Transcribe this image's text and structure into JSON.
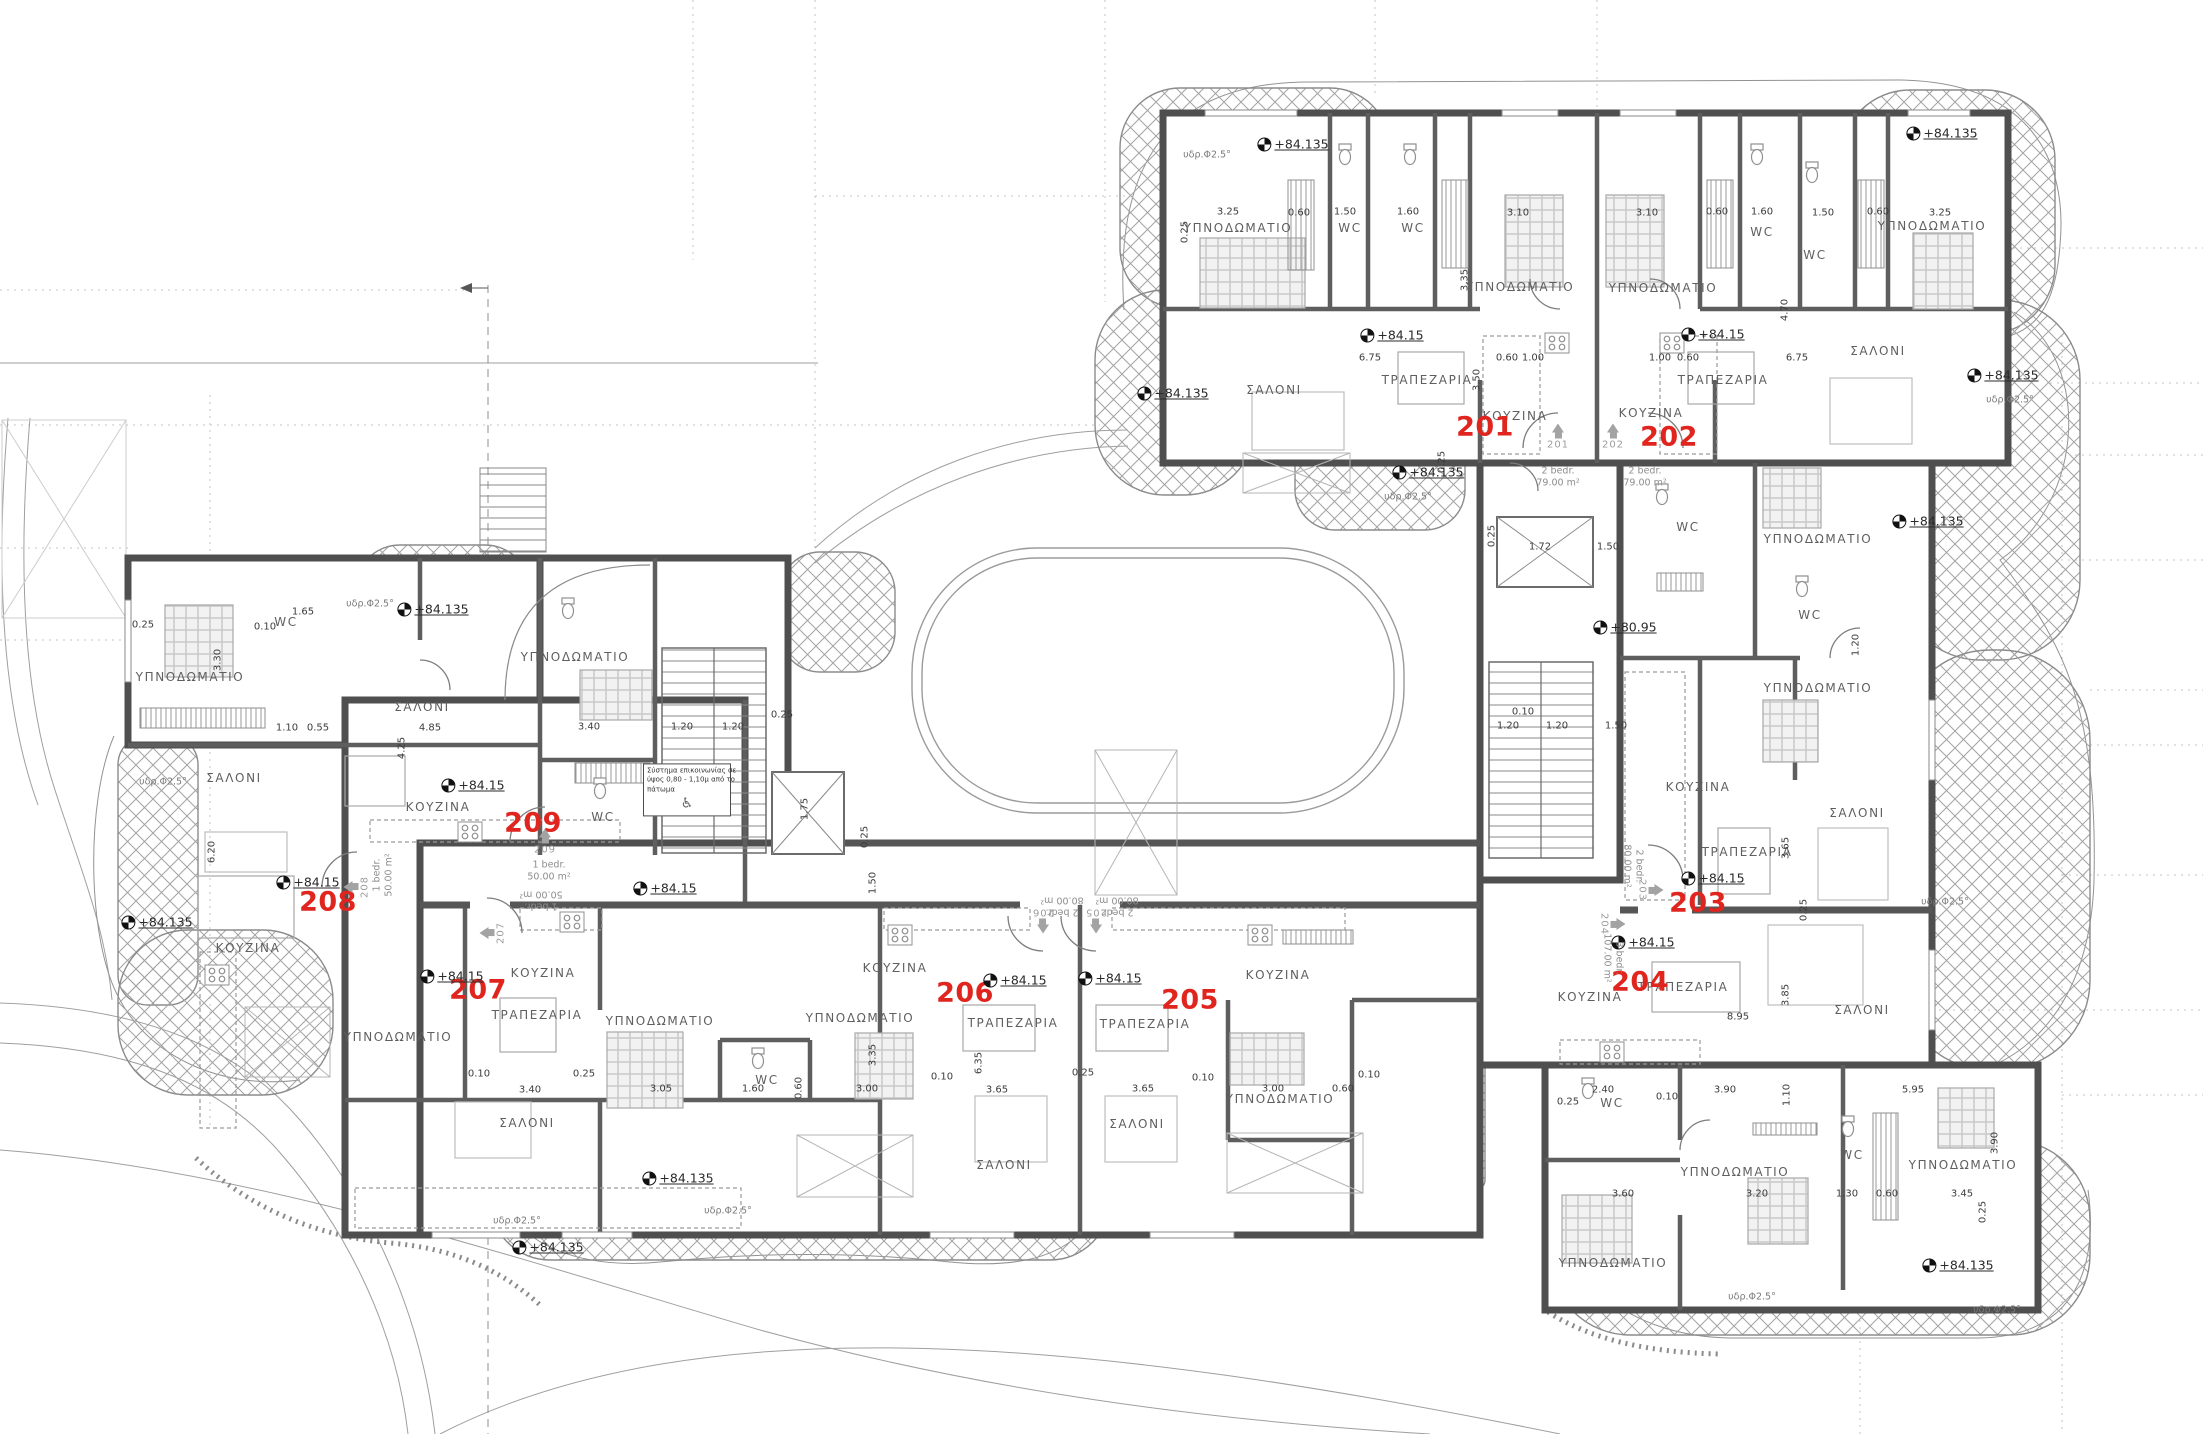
{
  "palette": {
    "red": "#e0251f",
    "wall": "#4f4f4f",
    "innerwall": "#616161",
    "hatch": "#9a9a9a",
    "text": "#5f5f5f"
  },
  "apartments": [
    {
      "number": "201",
      "type": "2 bedr.",
      "area": "79.00 m²"
    },
    {
      "number": "202",
      "type": "2 bedr.",
      "area": "79.00 m²"
    },
    {
      "number": "203",
      "type": "2 bedr.",
      "area": "80.00 m²"
    },
    {
      "number": "204",
      "type": "3 bedr.",
      "area": "107.00 m²"
    },
    {
      "number": "205",
      "type": "2 bedr.",
      "area": "80.00 m²"
    },
    {
      "number": "206",
      "type": "2 bedr.",
      "area": "80.00 m²"
    },
    {
      "number": "207",
      "type": "1 bedr.",
      "area": "50.00 m²"
    },
    {
      "number": "208",
      "type": "1 bedr.",
      "area": "50.00 m²"
    },
    {
      "number": "209",
      "type": "1 bedr.",
      "area": "50.00 m²"
    }
  ],
  "labels": {
    "rooms": [
      [
        "ΥΠΝΟΔΩΜΑΤΙΟ",
        1238,
        228
      ],
      [
        "WC",
        1350,
        228
      ],
      [
        "WC",
        1413,
        228
      ],
      [
        "ΥΠΝΟΔΩΜΑΤΙΟ",
        1520,
        287
      ],
      [
        "ΥΠΝΟΔΩΜΑΤΙΟ",
        1663,
        288
      ],
      [
        "WC",
        1762,
        232
      ],
      [
        "WC",
        1815,
        255
      ],
      [
        "ΥΠΝΟΔΩΜΑΤΙΟ",
        1932,
        226
      ],
      [
        "ΣΑΛΟΝΙ",
        1274,
        390
      ],
      [
        "ΤΡΑΠΕΖΑΡΙΑ",
        1427,
        380
      ],
      [
        "ΚΟΥΖΙΝΑ",
        1515,
        416
      ],
      [
        "ΚΟΥΖΙΝΑ",
        1651,
        413
      ],
      [
        "ΤΡΑΠΕΖΑΡΙΑ",
        1723,
        380
      ],
      [
        "ΣΑΛΟΝΙ",
        1878,
        351
      ],
      [
        "ΥΠΝΟΔΩΜΑΤΙΟ",
        1818,
        539
      ],
      [
        "WC",
        1688,
        527
      ],
      [
        "WC",
        1810,
        615
      ],
      [
        "ΥΠΝΟΔΩΜΑΤΙΟ",
        1818,
        688
      ],
      [
        "ΚΟΥΖΙΝΑ",
        1698,
        787
      ],
      [
        "ΣΑΛΟΝΙ",
        1857,
        813
      ],
      [
        "ΤΡΑΠΕΖΑΡΙΑ",
        1747,
        852
      ],
      [
        "ΚΟΥΖΙΝΑ",
        1590,
        997
      ],
      [
        "ΤΡΑΠΕΖΑΡΙΑ",
        1683,
        987
      ],
      [
        "ΣΑΛΟΝΙ",
        1862,
        1010
      ],
      [
        "WC",
        1612,
        1103
      ],
      [
        "ΥΠΝΟΔΩΜΑΤΙΟ",
        1735,
        1172
      ],
      [
        "WC",
        1852,
        1155
      ],
      [
        "ΥΠΝΟΔΩΜΑΤΙΟ",
        1963,
        1165
      ],
      [
        "ΥΠΝΟΔΩΜΑΤΙΟ",
        1613,
        1263
      ],
      [
        "ΥΠΝΟΔΩΜΑΤΙΟ",
        190,
        677
      ],
      [
        "WC",
        286,
        622
      ],
      [
        "ΣΑΛΟΝΙ",
        234,
        778
      ],
      [
        "ΚΟΥΖΙΝΑ",
        248,
        948
      ],
      [
        "ΣΑΛΟΝΙ",
        422,
        707
      ],
      [
        "ΚΟΥΖΙΝΑ",
        438,
        807
      ],
      [
        "ΥΠΝΟΔΩΜΑΤΙΟ",
        575,
        657
      ],
      [
        "WC",
        603,
        817
      ],
      [
        "ΥΠΝΟΔΩΜΑΤΙΟ",
        398,
        1037
      ],
      [
        "ΤΡΑΠΕΖΑΡΙΑ",
        537,
        1015
      ],
      [
        "ΚΟΥΖΙΝΑ",
        543,
        973
      ],
      [
        "ΣΑΛΟΝΙ",
        527,
        1123
      ],
      [
        "ΥΠΝΟΔΩΜΑΤΙΟ",
        660,
        1021
      ],
      [
        "ΥΠΝΟΔΩΜΑΤΙΟ",
        860,
        1018
      ],
      [
        "WC",
        767,
        1080
      ],
      [
        "ΚΟΥΖΙΝΑ",
        895,
        968
      ],
      [
        "ΤΡΑΠΕΖΑΡΙΑ",
        1013,
        1023
      ],
      [
        "ΣΑΛΟΝΙ",
        1004,
        1165
      ],
      [
        "ΤΡΑΠΕΖΑΡΙΑ",
        1145,
        1024
      ],
      [
        "ΣΑΛΟΝΙ",
        1137,
        1124
      ],
      [
        "ΚΟΥΖΙΝΑ",
        1278,
        975
      ],
      [
        "ΥΠΝΟΔΩΜΑΤΙΟ",
        1280,
        1099
      ]
    ],
    "red_numbers": [
      [
        "201",
        1485,
        427
      ],
      [
        "202",
        1669,
        437
      ],
      [
        "203",
        1698,
        903
      ],
      [
        "204",
        1640,
        982
      ],
      [
        "205",
        1190,
        1000
      ],
      [
        "206",
        965,
        993
      ],
      [
        "207",
        478,
        990
      ],
      [
        "208",
        328,
        902
      ],
      [
        "209",
        533,
        823
      ]
    ],
    "elevations": [
      [
        "+84.15",
        1392,
        335
      ],
      [
        "+84.15",
        1713,
        334
      ],
      [
        "+84.15",
        1713,
        878
      ],
      [
        "+84.15",
        1643,
        942
      ],
      [
        "+84.15",
        308,
        882
      ],
      [
        "+84.15",
        473,
        785
      ],
      [
        "+84.15",
        665,
        888
      ],
      [
        "+84.15",
        452,
        976
      ],
      [
        "+84.15",
        1015,
        980
      ],
      [
        "+84.15",
        1110,
        978
      ],
      [
        "+80.95",
        1625,
        627
      ],
      [
        "+84.135",
        1293,
        144
      ],
      [
        "+84.135",
        1942,
        133
      ],
      [
        "+84.135",
        1173,
        393
      ],
      [
        "+84.135",
        1428,
        472
      ],
      [
        "+84.135",
        2003,
        375
      ],
      [
        "+84.135",
        1928,
        521
      ],
      [
        "+84.135",
        433,
        609
      ],
      [
        "+84.135",
        157,
        922
      ],
      [
        "+84.135",
        548,
        1247
      ],
      [
        "+84.135",
        678,
        1178
      ],
      [
        "+84.135",
        1958,
        1265
      ]
    ],
    "slopes": [
      [
        "υδρ.Φ2.5°",
        1207,
        155
      ],
      [
        "υδρ.Φ2.5°",
        370,
        604
      ],
      [
        "υδρ.Φ2.5°",
        163,
        782
      ],
      [
        "υδρ.Φ2.5°",
        2010,
        400
      ],
      [
        "υδρ.Φ2.5°",
        1408,
        497
      ],
      [
        "υδρ.Φ2.5°",
        1945,
        902
      ],
      [
        "υδρ.Φ2.5°",
        517,
        1221
      ],
      [
        "υδρ.Φ2.5°",
        728,
        1211
      ],
      [
        "υδρ.Φ2.5°",
        1752,
        1297
      ],
      [
        "υδρ.Φ2.5°",
        1997,
        1310
      ]
    ],
    "dims": [
      [
        "3.25",
        1228,
        212
      ],
      [
        "0.60",
        1299,
        213
      ],
      [
        "1.50",
        1345,
        212
      ],
      [
        "1.60",
        1408,
        212
      ],
      [
        "3.10",
        1518,
        213
      ],
      [
        "3.10",
        1647,
        213
      ],
      [
        "0.60",
        1717,
        212
      ],
      [
        "1.60",
        1762,
        212
      ],
      [
        "1.50",
        1823,
        213
      ],
      [
        "0.60",
        1878,
        212
      ],
      [
        "3.25",
        1940,
        213
      ],
      [
        "0.25",
        1185,
        232,
        -90
      ],
      [
        "3.35",
        1465,
        280,
        -90
      ],
      [
        "3.50",
        1477,
        380,
        -90
      ],
      [
        "6.75",
        1370,
        358
      ],
      [
        "6.75",
        1797,
        358
      ],
      [
        "4.70",
        1785,
        310,
        -90
      ],
      [
        "0.60",
        1507,
        358
      ],
      [
        "1.00",
        1533,
        358
      ],
      [
        "1.00",
        1660,
        358
      ],
      [
        "0.60",
        1688,
        358
      ],
      [
        "0.25",
        1442,
        462,
        -90
      ],
      [
        "1.72",
        1540,
        547
      ],
      [
        "1.50",
        1608,
        547
      ],
      [
        "0.25",
        1492,
        536,
        -90
      ],
      [
        "1.20",
        1508,
        726
      ],
      [
        "1.20",
        1557,
        726
      ],
      [
        "1.50",
        1616,
        726
      ],
      [
        "0.10",
        1523,
        712
      ],
      [
        "1.20",
        1856,
        645,
        -90
      ],
      [
        "3.65",
        1786,
        848,
        -90
      ],
      [
        "3.85",
        1786,
        995,
        -90
      ],
      [
        "8.95",
        1738,
        1017
      ],
      [
        "0.25",
        1804,
        910,
        -90
      ],
      [
        "2.40",
        1603,
        1090
      ],
      [
        "3.90",
        1725,
        1090
      ],
      [
        "5.95",
        1913,
        1090
      ],
      [
        "0.25",
        1568,
        1102
      ],
      [
        "0.10",
        1667,
        1097
      ],
      [
        "3.60",
        1623,
        1194
      ],
      [
        "3.20",
        1757,
        1194
      ],
      [
        "1.30",
        1847,
        1194
      ],
      [
        "0.60",
        1887,
        1194
      ],
      [
        "3.45",
        1962,
        1194
      ],
      [
        "1.10",
        1787,
        1095,
        -90
      ],
      [
        "3.90",
        1995,
        1143,
        -90
      ],
      [
        "0.25",
        1983,
        1212,
        -90
      ],
      [
        "0.25",
        143,
        625
      ],
      [
        "1.65",
        303,
        612
      ],
      [
        "0.10",
        265,
        627
      ],
      [
        "3.30",
        218,
        660,
        -90
      ],
      [
        "1.10",
        287,
        728
      ],
      [
        "0.55",
        318,
        728
      ],
      [
        "4.85",
        430,
        728
      ],
      [
        "4.25",
        402,
        748,
        -90
      ],
      [
        "6.20",
        212,
        852,
        -90
      ],
      [
        "3.40",
        589,
        727
      ],
      [
        "1.20",
        682,
        727
      ],
      [
        "1.20",
        733,
        727
      ],
      [
        "0.25",
        782,
        715
      ],
      [
        "1.75",
        805,
        809,
        -90
      ],
      [
        "1.50",
        873,
        883,
        -90
      ],
      [
        "0.25",
        865,
        837,
        -90
      ],
      [
        "0.10",
        479,
        1074
      ],
      [
        "3.40",
        530,
        1090
      ],
      [
        "0.25",
        584,
        1074
      ],
      [
        "3.05",
        661,
        1089
      ],
      [
        "1.60",
        753,
        1089
      ],
      [
        "0.60",
        799,
        1088,
        -90
      ],
      [
        "3.00",
        867,
        1089
      ],
      [
        "3.35",
        873,
        1055,
        -90
      ],
      [
        "6.35",
        979,
        1063,
        -90
      ],
      [
        "3.65",
        997,
        1090
      ],
      [
        "3.65",
        1143,
        1089
      ],
      [
        "0.25",
        1083,
        1073
      ],
      [
        "0.10",
        942,
        1077
      ],
      [
        "0.10",
        1203,
        1078
      ],
      [
        "3.00",
        1273,
        1089
      ],
      [
        "0.60",
        1343,
        1089
      ],
      [
        "0.10",
        1369,
        1075
      ]
    ],
    "door_markers": [
      [
        "201",
        1558,
        437,
        0
      ],
      [
        "202",
        1613,
        437,
        0
      ],
      [
        "203",
        1650,
        890,
        90
      ],
      [
        "204",
        1612,
        924,
        90
      ],
      [
        "205",
        1096,
        920,
        180
      ],
      [
        "206",
        1043,
        920,
        180
      ],
      [
        "207",
        493,
        933,
        -90
      ],
      [
        "208",
        357,
        887,
        -90
      ],
      [
        "209",
        545,
        842,
        0
      ]
    ],
    "apt_info": [
      [
        [
          "2 bedr.",
          "79.00 m²"
        ],
        1558,
        478,
        0
      ],
      [
        [
          "2 bedr.",
          "79.00 m²"
        ],
        1645,
        478,
        0
      ],
      [
        [
          "2 bedr.",
          "80.00 m²"
        ],
        1632,
        866,
        90
      ],
      [
        [
          "3 bedr.",
          "107.00 m²"
        ],
        1612,
        958,
        90
      ],
      [
        [
          "2 bedr.",
          "80.00 m²"
        ],
        1117,
        905,
        180
      ],
      [
        [
          "2 bedr.",
          "80.00 m²"
        ],
        1062,
        905,
        180
      ],
      [
        [
          "1 bedr.",
          "50.00 m²"
        ],
        541,
        899,
        180
      ],
      [
        [
          "1 bedr.",
          "50.00 m²"
        ],
        384,
        875,
        -90
      ],
      [
        [
          "1 bedr.",
          "50.00 m²"
        ],
        549,
        872,
        0
      ]
    ],
    "note": {
      "lines": [
        "Σύστημα επικοινωνίας σε",
        "ύψος 0,80 - 1,10μ από το",
        "πάτωμα"
      ],
      "icon": "♿",
      "x": 687,
      "y": 790
    }
  }
}
